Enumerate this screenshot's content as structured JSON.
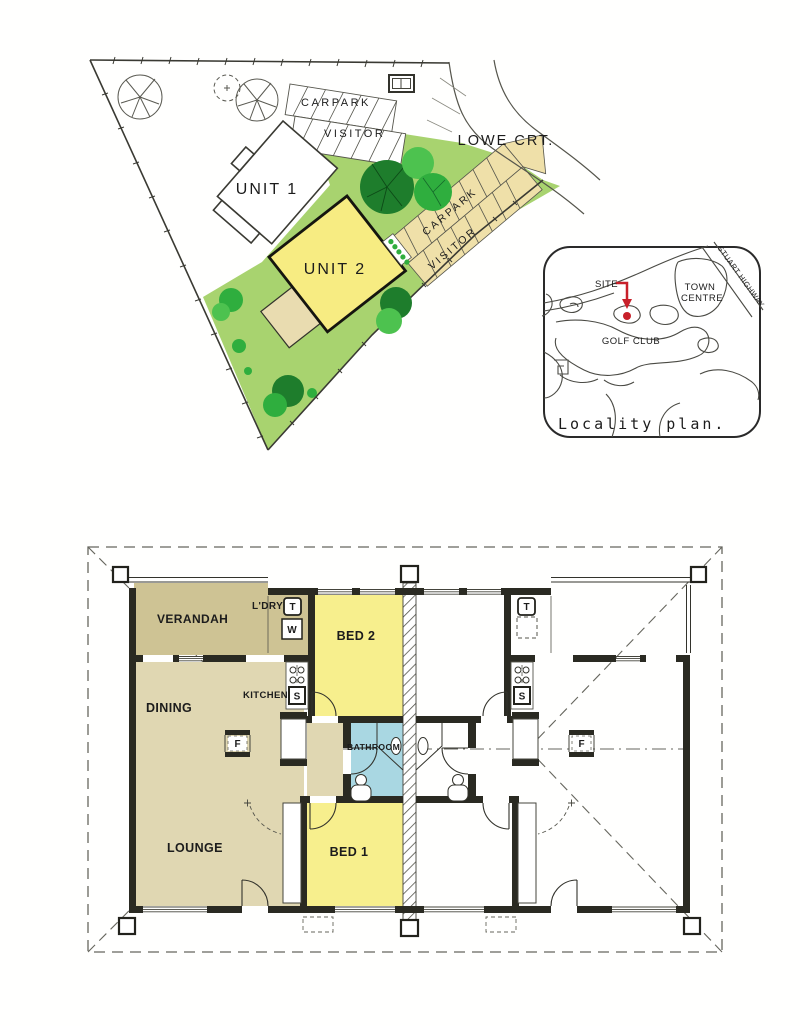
{
  "site_plan": {
    "street": "LOWE CRT.",
    "buildings": {
      "unit1": "UNIT 1",
      "unit2": "UNIT 2"
    },
    "parking_top": {
      "row1": "CARPARK",
      "row2": "VISITOR"
    },
    "parking_side": {
      "row1": "CARPARK",
      "row2": "VISITOR"
    },
    "colors": {
      "lawn": "#A8D36F",
      "tree_dark": "#1E7D2C",
      "tree_mid": "#2FAE3E",
      "tree_light": "#4DC24F",
      "carpark_beige": "#EFE0A9",
      "unit2_yellow": "#F7EC82",
      "porch_beige": "#E9DCB0",
      "outline": "#3A3A33"
    }
  },
  "locality_plan": {
    "site_label": "SITE",
    "town_centre": [
      "TOWN",
      "CENTRE"
    ],
    "highway": "STUART HIGHWAY",
    "golf_club": "GOLF CLUB",
    "caption": "Locality plan.",
    "marker_red": "#C8202A"
  },
  "floor_plan": {
    "rooms": {
      "verandah": "VERANDAH",
      "laundry": "L'DRY",
      "bed2": "BED 2",
      "dining": "DINING",
      "kitchen": "KITCHEN",
      "bathroom": "BATHROOM",
      "lounge": "LOUNGE",
      "bed1": "BED 1"
    },
    "fixtures": {
      "trough": "T",
      "washer": "W",
      "sink": "S",
      "fridge": "F"
    },
    "colors": {
      "floor_tan": "#E0D7B2",
      "verandah_tan": "#CEC394",
      "bed_yellow": "#F7EF8D",
      "bath_blue": "#A9D7E2",
      "wall": "#2A2A22"
    }
  }
}
